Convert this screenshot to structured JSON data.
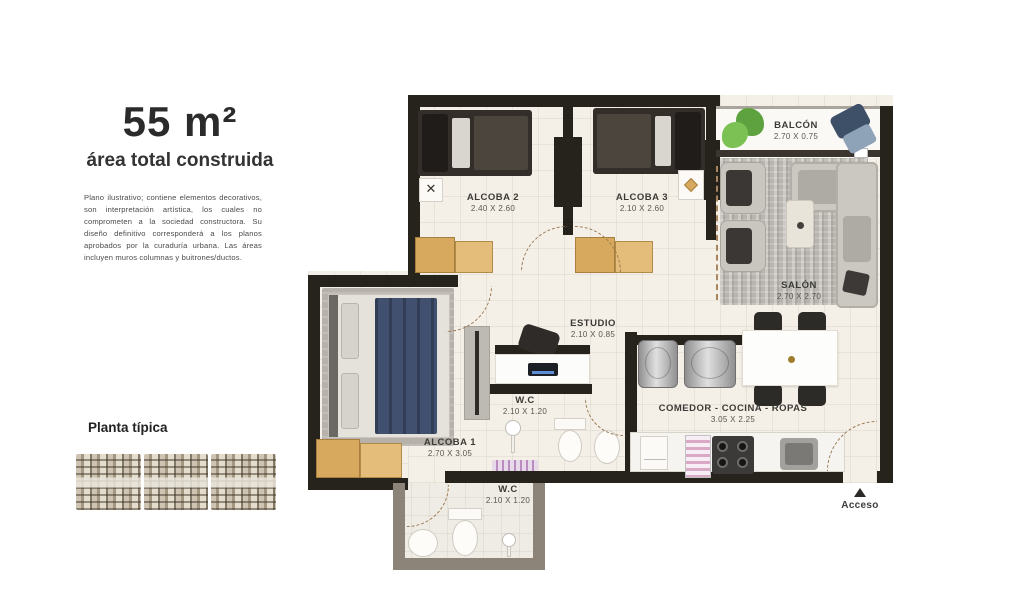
{
  "panel": {
    "area_title": "55 m²",
    "area_subtitle": "área total construida",
    "disclaimer": "Plano ilustrativo; contiene elementos decorativos, son interpretación artística, los cuales no comprometen a la sociedad constructora. Su diseño definitivo corresponderá a los planos aprobados por la curaduría urbana. Las áreas incluyen muros columnas y buitrones/ductos.",
    "floor_plan_label": "Planta típica"
  },
  "rooms": {
    "alcoba2": {
      "name": "ALCOBA 2",
      "dims": "2.40 X 2.60"
    },
    "alcoba3": {
      "name": "ALCOBA 3",
      "dims": "2.10 X 2.60"
    },
    "balcon": {
      "name": "BALCÓN",
      "dims": "2.70 X 0.75"
    },
    "salon": {
      "name": "SALÓN",
      "dims": "2.70 X 2.70"
    },
    "estudio": {
      "name": "ESTUDIO",
      "dims": "2.10 X 0.85"
    },
    "wc_1": {
      "name": "W.C",
      "dims": "2.10 X 1.20"
    },
    "alcoba1": {
      "name": "ALCOBA 1",
      "dims": "2.70 X 3.05"
    },
    "comedor": {
      "name": "COMEDOR - COCINA - ROPAS",
      "dims": "3.05 X 2.25"
    },
    "wc_2": {
      "name": "W.C",
      "dims": "2.10 X 1.20"
    }
  },
  "access": {
    "label": "Acceso"
  },
  "colors": {
    "wall": "#26221c",
    "wood": "#d6a95f",
    "floor": "#f4f0e8",
    "duvet_blue": "#40506e",
    "accent_green": "#5da23f"
  }
}
